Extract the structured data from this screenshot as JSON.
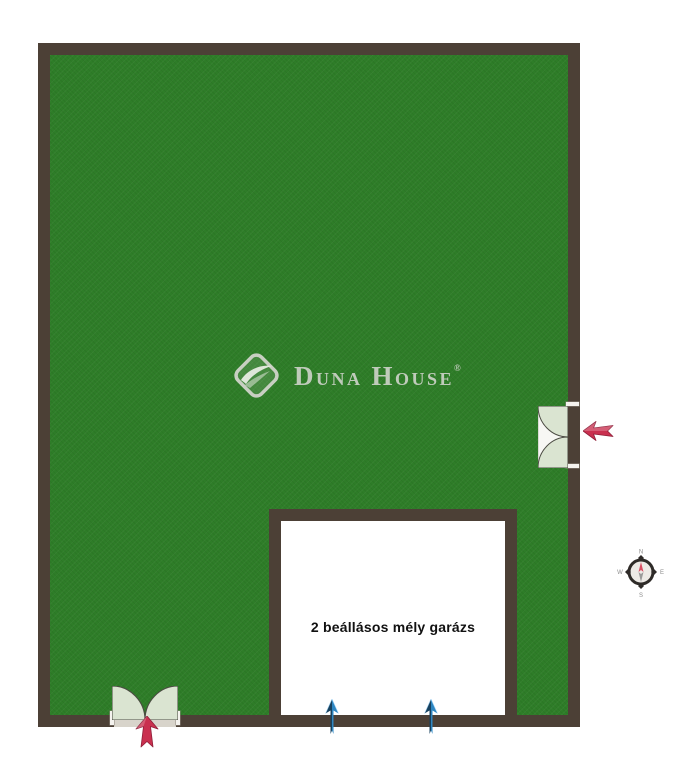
{
  "plan": {
    "type": "site-floorplan",
    "garage": {
      "label": "2 beállásos mély garázs"
    },
    "watermark": {
      "d": "D",
      "una": "UNA",
      "h": "H",
      "ouse": "OUSE",
      "reg": "®"
    },
    "compass": {
      "north": "N",
      "east": "E",
      "south": "S",
      "west": "W"
    }
  },
  "colors": {
    "background": "#ffffff",
    "grass": "#2e7d28",
    "wall": "#4c4036",
    "door_leaf": "#dae4d1",
    "door_opening": "#d8d4cb",
    "garage_floor": "#ffffff",
    "entrance_arrow": "#c9304f",
    "ramp_arrow_dark": "#17415e",
    "ramp_arrow_light": "#2e86c1",
    "watermark": "#ccd2c7",
    "compass_ring": "#2e2b28",
    "compass_face": "#edeae6",
    "compass_needle_north": "#d94f63",
    "compass_needle_south": "#9a9a9a",
    "compass_letter": "#8a8a8a",
    "text": "#111111"
  }
}
